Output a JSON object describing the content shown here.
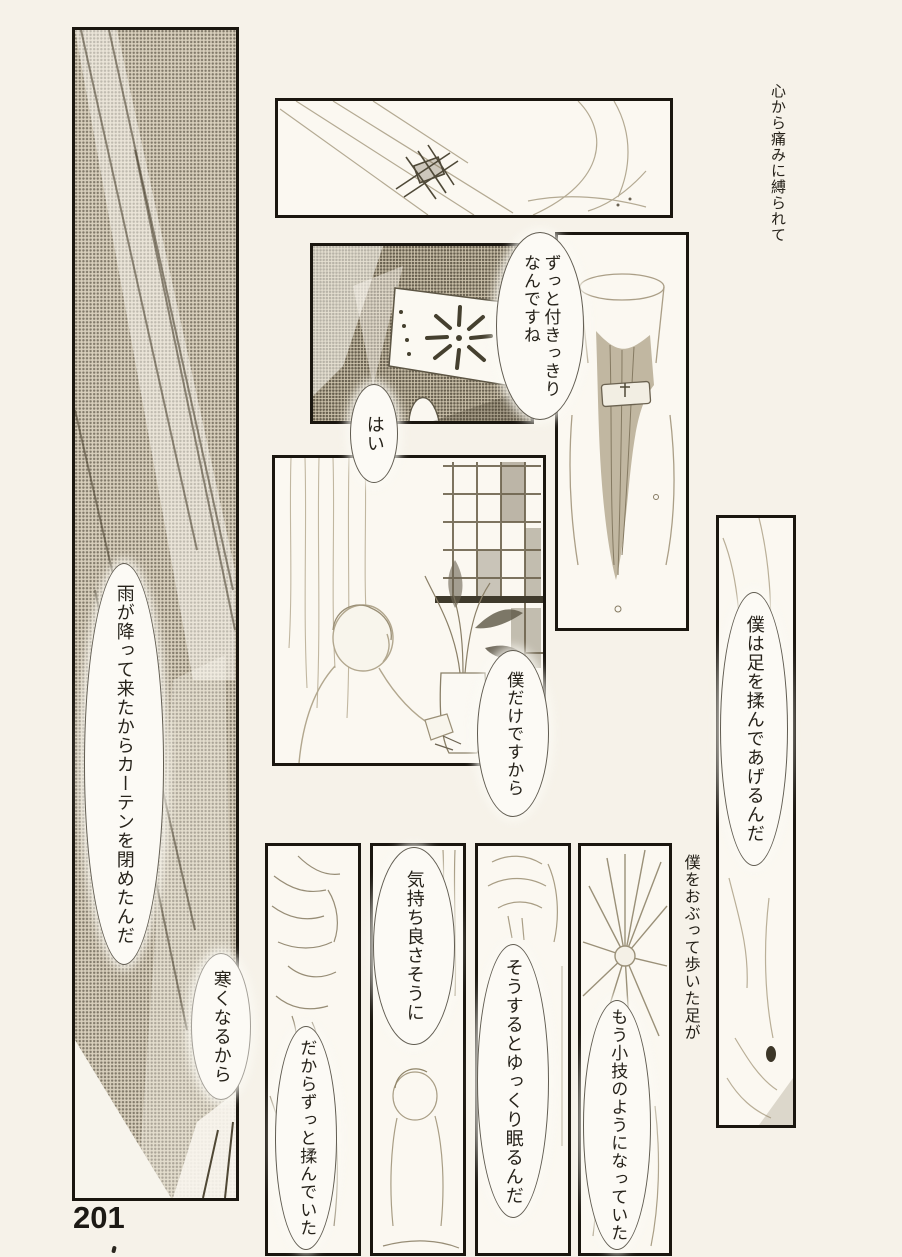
{
  "page_number": "201",
  "captions": {
    "narration_top": "心から痛みに縛られて",
    "narration_feet": "僕をおぶって歩いた足が"
  },
  "dialogue": {
    "attend": "ずっと付きっきり\nなんですね",
    "yes": "はい",
    "rain": "雨が降って来たからカーテンを閉めたんだ",
    "cold": "寒くなるから",
    "only_me": "僕だけですから",
    "massage_feet": "僕は足を揉んであげるんだ",
    "feels_good": "気持ち良さそうに",
    "kept_rubbing": "だからずっと揉んでいた",
    "falls_asleep": "そうするとゆっくり眠るんだ",
    "second_nature": "もう小技のようになっていた"
  },
  "colors": {
    "paper": "#f6f2e9",
    "ink": "#26221a",
    "panel_fill": "#fbf8f1",
    "screentone": "#d8cfbc"
  }
}
